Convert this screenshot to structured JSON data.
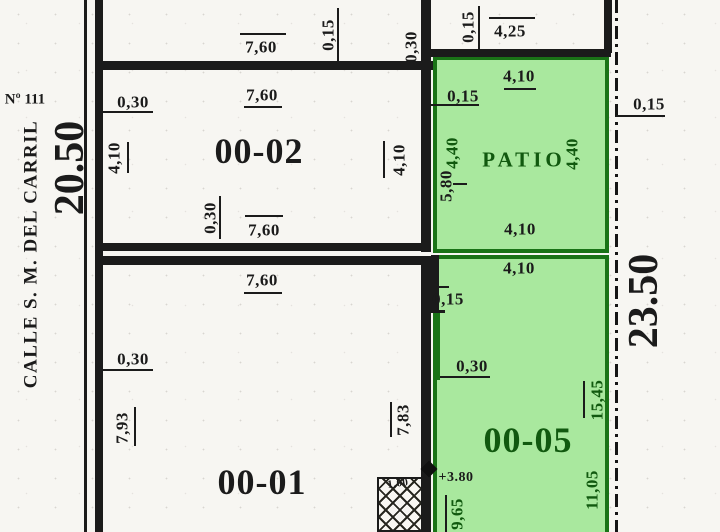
{
  "street": {
    "name": "CALLE S. M. DEL CARRIL",
    "number": "Nº 111",
    "frontage": "20.50"
  },
  "right_boundary": {
    "depth": "23.50",
    "setback": "0,15"
  },
  "rooms": {
    "room_00_02": {
      "label": "00-02"
    },
    "room_00_01": {
      "label": "00-01"
    },
    "lot_00_05": {
      "label": "00-05"
    },
    "patio": {
      "label": "PATIO"
    }
  },
  "annotations": {
    "level_mark": "+3.80",
    "hatch_label": "1,00"
  },
  "colors": {
    "paper": "#f7f6f2",
    "ink": "#1b1b1b",
    "green_fill": "#a9e89e",
    "green_border": "#1a7317",
    "green_text": "#11590f"
  },
  "dim_labels": [
    {
      "text": "7,60",
      "region": "top_block",
      "x": 261,
      "y": 47
    },
    {
      "text": "0,15",
      "region": "top_block",
      "x": 328,
      "y": 35,
      "rot": -90
    },
    {
      "text": "0,30",
      "region": "top_block",
      "x": 411,
      "y": 47,
      "rot": -90
    },
    {
      "text": "0,15",
      "region": "top_right_block",
      "x": 468,
      "y": 27,
      "rot": -90
    },
    {
      "text": "4,25",
      "region": "top_right_block",
      "x": 510,
      "y": 31
    },
    {
      "text": "0,30",
      "region": "room_00_02",
      "x": 133,
      "y": 102
    },
    {
      "text": "7,60",
      "region": "room_00_02",
      "x": 262,
      "y": 95
    },
    {
      "text": "4,10",
      "region": "room_00_02",
      "x": 114,
      "y": 158,
      "rot": -90
    },
    {
      "text": "4,10",
      "region": "room_00_02",
      "x": 399,
      "y": 160,
      "rot": -90
    },
    {
      "text": "0,30",
      "region": "room_00_02",
      "x": 210,
      "y": 218,
      "rot": -90
    },
    {
      "text": "7,60",
      "region": "room_00_02",
      "x": 264,
      "y": 230
    },
    {
      "text": "7,60",
      "region": "room_00_01",
      "x": 262,
      "y": 280
    },
    {
      "text": "0,30",
      "region": "room_00_01",
      "x": 133,
      "y": 359
    },
    {
      "text": "7,83",
      "region": "room_00_01",
      "x": 403,
      "y": 420,
      "rot": -90
    },
    {
      "text": "7,93",
      "region": "room_00_01",
      "x": 122,
      "y": 428,
      "rot": -90
    },
    {
      "text": "4,10",
      "region": "patio",
      "x": 519,
      "y": 76
    },
    {
      "text": "0,15",
      "region": "patio",
      "x": 463,
      "y": 96
    },
    {
      "text": "4,40",
      "region": "patio",
      "x": 452,
      "y": 153,
      "rot": -90,
      "color": "green"
    },
    {
      "text": "5,80",
      "region": "patio",
      "x": 446,
      "y": 186,
      "rot": -90
    },
    {
      "text": "4,40",
      "region": "patio",
      "x": 572,
      "y": 154,
      "rot": -90,
      "color": "green"
    },
    {
      "text": "4,10",
      "region": "patio",
      "x": 520,
      "y": 229
    },
    {
      "text": "4,10",
      "region": "lot_00_05",
      "x": 519,
      "y": 268
    },
    {
      "text": "0,15",
      "region": "lot_00_05",
      "x": 448,
      "y": 299
    },
    {
      "text": "0,30",
      "region": "lot_00_05",
      "x": 472,
      "y": 366
    },
    {
      "text": "15,45",
      "region": "lot_00_05",
      "x": 597,
      "y": 400,
      "rot": -90,
      "color": "green"
    },
    {
      "text": "11,05",
      "region": "lot_00_05",
      "x": 592,
      "y": 490,
      "rot": -90,
      "color": "green"
    },
    {
      "text": "9,65",
      "region": "lot_00_05",
      "x": 457,
      "y": 514,
      "rot": -90,
      "color": "green"
    },
    {
      "text": "+3.80",
      "region": "lot_00_05",
      "x": 456,
      "y": 478,
      "size": 14
    },
    {
      "text": "1,00",
      "region": "hatch_box",
      "x": 398,
      "y": 484,
      "size": 11,
      "rot": -8
    },
    {
      "text": "0,15",
      "region": "boundary_right",
      "x": 649,
      "y": 104
    }
  ]
}
